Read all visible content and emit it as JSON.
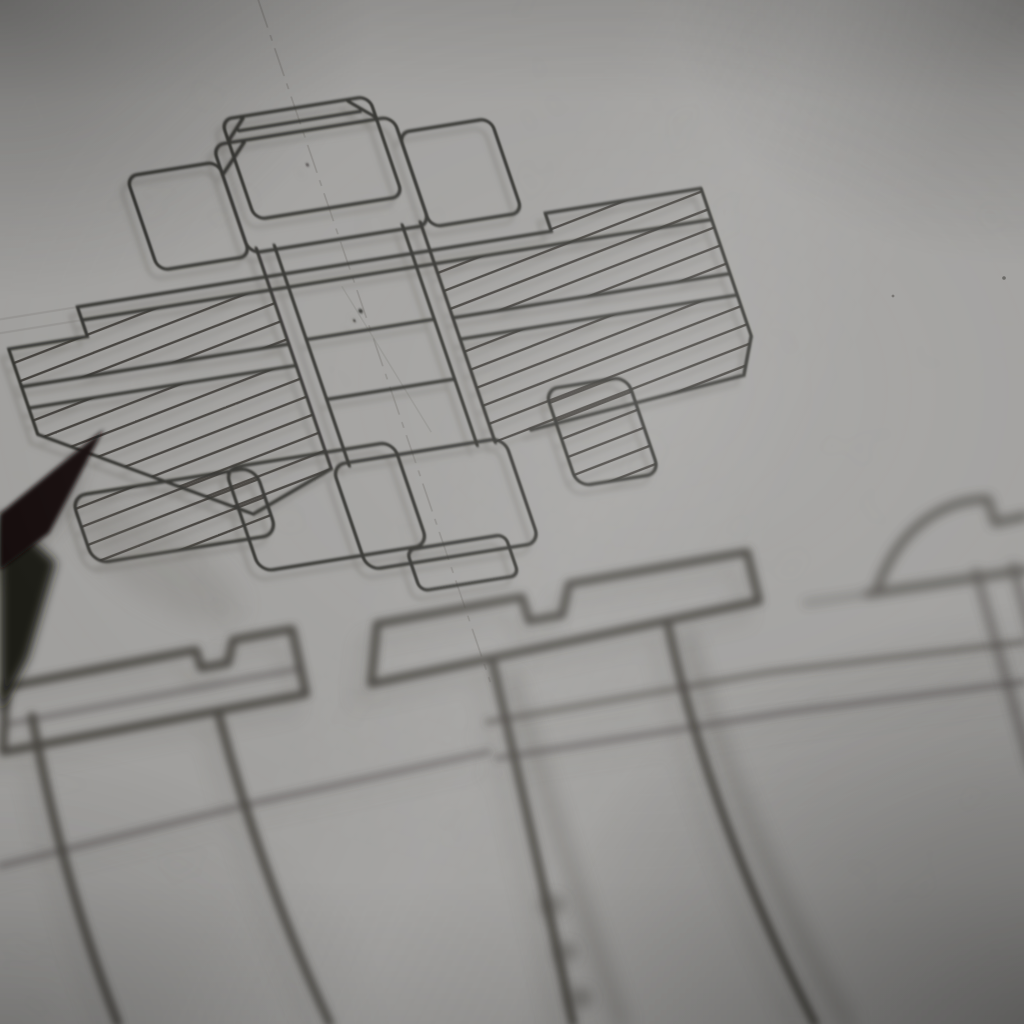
{
  "meta": {
    "title": "Macro photograph of a technical drawing",
    "description": "Black-and-white close-up photograph of a hand-drafted engineering drawing on grey paper: an in-focus sectional view of a threaded pipe union with hex nuts and diagonally hatched section faces, a vertical dash-dot centerline, three out-of-focus slotted machine-screw drawings in the foreground below, and the dark blurred tip of a pencil entering from the left edge.",
    "image_type": "photograph",
    "monochrome": true
  },
  "palette": {
    "paper": "#a1a09e",
    "paper_light": "#b3b2b0",
    "ink": "#33312d",
    "hatch": "#44413d",
    "faint": "#7a7874",
    "shadow_ink": "#6e6c66",
    "blur_ink": "#474440",
    "pencil_tip": "#121110",
    "pencil_body": "#1b1a18"
  },
  "drawing": {
    "subject": "pipe union cross-section with upper and lower hex nuts",
    "line_style": "dark pencil/ink drafting lines, slightly soft focus",
    "hatch": {
      "spacing": 22,
      "slope": -0.2
    },
    "centerline_style": "vertical dash-dot construction line",
    "features": [
      "chamfered hex-nut top face drawn as overlapping rounded rectangles",
      "thin flange band with stepped right shoulder",
      "left and right section-hatched flange blocks split by a plain seam band",
      "double-walled central bore with horizontal joint lines",
      "lower hex nut of overlapping rounded rectangles",
      "small ink specks on the paper"
    ]
  },
  "foreground_drawings": [
    {
      "name": "center-slotted-screw",
      "description": "blurred side view of a slotted flat-head screw, slot notch at top, long tapering shank running off the bottom edge",
      "focus": "out of focus"
    },
    {
      "name": "left-slotted-screw",
      "description": "blurred wide flat screw head with slot, double shank lines running to lower-left",
      "focus": "out of focus"
    },
    {
      "name": "right-round-head-screw",
      "description": "blurred dome-head screw cropped by the right edge, shank exiting lower right",
      "focus": "very out of focus"
    },
    {
      "name": "surface-lines",
      "description": "long faint horizontal datum lines running across the lower half"
    }
  ],
  "pencil": {
    "description": "sharpened pencil tip entering from the left edge, dark cone with soft double image and faint cast shadow",
    "position": "left edge, mid height"
  },
  "photo_effects": {
    "vignette": "darkened corners, strongest lower-right and upper-left",
    "highlight": "soft light band across upper-center of the sheet",
    "grain": "fine paper grain and mottling"
  }
}
